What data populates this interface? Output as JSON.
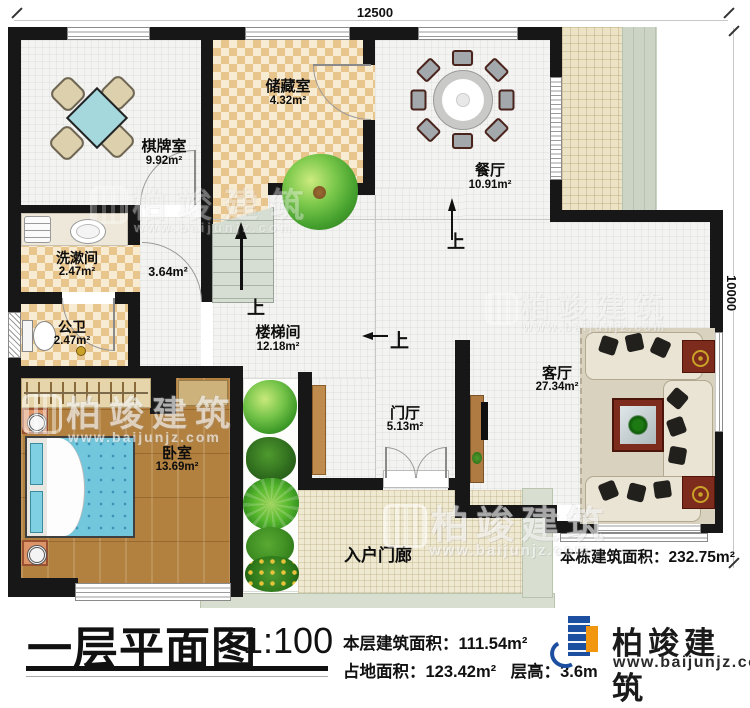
{
  "dimensions": {
    "top": "12500",
    "right": "10000"
  },
  "rooms": [
    {
      "id": "qipaishi",
      "name": "棋牌室",
      "area": "9.92m²"
    },
    {
      "id": "chucangshi",
      "name": "储藏室",
      "area": "4.32m²"
    },
    {
      "id": "canting",
      "name": "餐厅",
      "area": "10.91m²"
    },
    {
      "id": "xishujian",
      "name": "洗漱间",
      "area": "2.47m²"
    },
    {
      "id": "hallway",
      "name": "",
      "area": "3.64m²"
    },
    {
      "id": "gongwei",
      "name": "公卫",
      "area": "2.47m²"
    },
    {
      "id": "loutijian",
      "name": "楼梯间",
      "area": "12.18m²"
    },
    {
      "id": "woshi",
      "name": "卧室",
      "area": "13.69m²"
    },
    {
      "id": "menting",
      "name": "门厅",
      "area": "5.13m²"
    },
    {
      "id": "keting",
      "name": "客厅",
      "area": "27.34m²"
    },
    {
      "id": "porch",
      "name": "入户门廊",
      "area": ""
    }
  ],
  "markers": {
    "up": "上"
  },
  "annotations": {
    "building_total": "本栋建筑面积：232.75m²"
  },
  "footer": {
    "title": "一层平面图",
    "scale": "1:100",
    "stat1_label": "本层建筑面积：",
    "stat1_value": "111.54m²",
    "stat2_label": "占地面积：",
    "stat2_value": "123.42m²",
    "stat3_label": "层高：",
    "stat3_value": "3.6m",
    "brand": "柏竣建筑",
    "url": "www.baijunjz.com"
  },
  "watermark": {
    "brand": "柏竣建筑",
    "url": "www.baijunjz.com"
  },
  "colors": {
    "wall": "#171717",
    "checker_tan": "#e9c58e",
    "wood_floor": "#b3813f",
    "bed_cyan": "#72c7dd",
    "table_cyan": "#a5d8dd",
    "step_green": "#d8dfd0",
    "logo_blue": "#1d4fa0",
    "logo_orange": "#f2960f"
  }
}
